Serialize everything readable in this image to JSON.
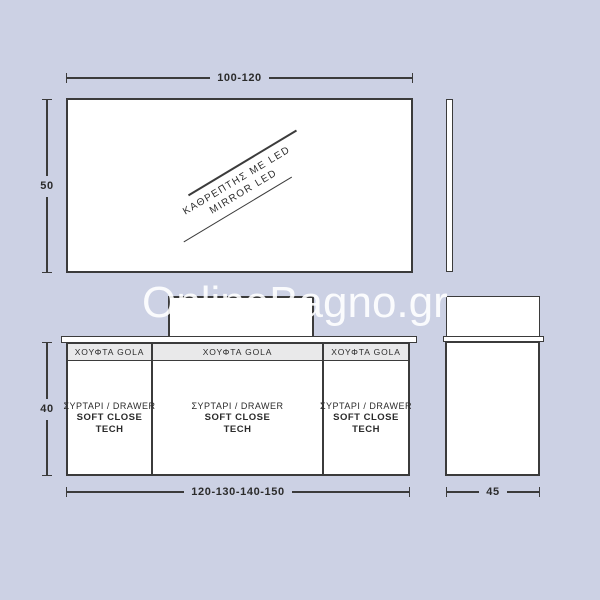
{
  "colors": {
    "background": "#ccd1e4",
    "line": "#3b3b3b",
    "panel": "#ffffff",
    "drawer_header_bg": "#e9e9ea",
    "text": "#2b2b2b"
  },
  "watermark": {
    "text": "OnlineBagno.gr",
    "color": "#ffffff"
  },
  "mirror_front": {
    "width_dim": "100-120",
    "height_dim": "50",
    "label_line1": "ΚΑΘΡΕΠΤΗΣ ΜΕ LED",
    "label_line2": "MIRROR LED"
  },
  "cabinet_front": {
    "width_dim": "120-130-140-150",
    "height_dim": "40",
    "sections": [
      {
        "handle_label": "ΧΟΥΦΤΑ GOLA",
        "drawer_line1": "ΣΥΡΤΑΡΙ / DRAWER",
        "drawer_line2": "SOFT CLOSE",
        "drawer_line3": "TECH"
      },
      {
        "handle_label": "ΧΟΥΦΤΑ GOLA",
        "drawer_line1": "ΣΥΡΤΑΡΙ / DRAWER",
        "drawer_line2": "SOFT CLOSE",
        "drawer_line3": "TECH"
      },
      {
        "handle_label": "ΧΟΥΦΤΑ GOLA",
        "drawer_line1": "ΣΥΡΤΑΡΙ / DRAWER",
        "drawer_line2": "SOFT CLOSE",
        "drawer_line3": "TECH"
      }
    ]
  },
  "cabinet_side": {
    "depth_dim": "45"
  }
}
